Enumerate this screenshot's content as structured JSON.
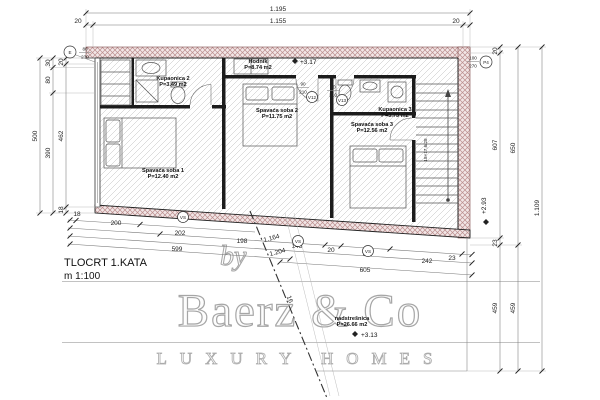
{
  "title_block": {
    "title": "TLOCRT 1.KATA",
    "scale": "m 1:100"
  },
  "watermark": {
    "by": "by",
    "brand": "Baerz & Co",
    "tagline": "LUXURY HOMES"
  },
  "rooms": {
    "hodnik": {
      "name": "Hodnik",
      "area": "P=8.74 m2"
    },
    "kupaonica2": {
      "name": "Kupaonica 2",
      "area": "P=3.49 m2"
    },
    "spavaca1": {
      "name": "Spavaća soba 1",
      "area": "P=12.40 m2"
    },
    "spavaca2": {
      "name": "Spavaća soba 2",
      "area": "P=11.75 m2"
    },
    "kupaonica3": {
      "name": "Kupaonica 3",
      "area": "P=3.73 m2"
    },
    "spavaca3": {
      "name": "Spavaća soba 3",
      "area": "P=12.56 m2"
    },
    "nadstresnica": {
      "name": "nadstrešnica",
      "area": "P=26.66 m2"
    }
  },
  "levels": {
    "hodnik": "+3.17",
    "stubiste": "+2.93",
    "terasa": "+3.13"
  },
  "dims": {
    "top": {
      "total": "1.195",
      "left": "20",
      "mid": "1.155",
      "right": "20"
    },
    "left": {
      "total": "500",
      "c2": [
        "30",
        "80",
        "390"
      ],
      "c3": [
        "20",
        "462",
        "18"
      ]
    },
    "right": {
      "c1": [
        "20",
        "607",
        "23",
        "459"
      ],
      "c2": [
        "650",
        "459"
      ],
      "total": "1.109"
    },
    "bottom": {
      "r1": [
        "18",
        "200"
      ],
      "r2": [
        "202",
        "145",
        "20",
        "145",
        "242",
        "23"
      ],
      "r3": [
        "198"
      ],
      "r4": [
        "599"
      ],
      "r5": [
        "605"
      ],
      "diag": [
        "1.164",
        "1.204"
      ]
    }
  },
  "tags": {
    "door_e": {
      "mark": "E",
      "top": "80",
      "bottom": "230"
    },
    "window_p": {
      "mark": "P4",
      "top": "100",
      "bottom": "270"
    },
    "door_v12": {
      "mark": "V12",
      "top": "90",
      "bottom": "210"
    },
    "door_v13": {
      "mark": "V13",
      "top": "90",
      "bottom": "210"
    },
    "vs": "VS",
    "stair_note": "18×17,6/28",
    "section": "16"
  }
}
